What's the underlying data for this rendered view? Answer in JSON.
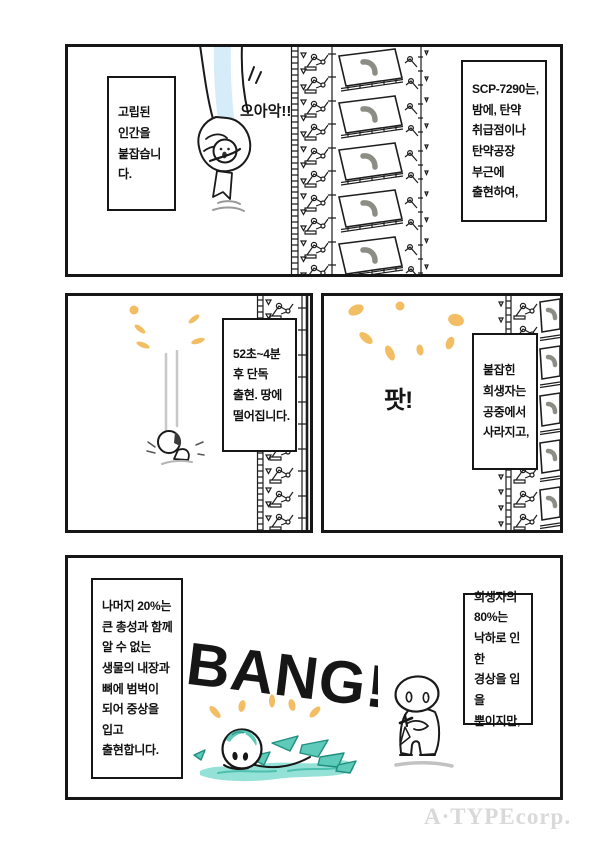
{
  "watermark": "A·TYPEcorp.",
  "colors": {
    "ink": "#1a1a1a",
    "accent_orange": "#f2bd63",
    "pale_blue": "#d6ecf8",
    "teal": "#5ecab9",
    "teal_light": "#93e1d7",
    "teal_dark": "#1f8f80",
    "watermark_gray": "#d9d9d9"
  },
  "panels": {
    "p1": {
      "caption_left": "고립된\n인간을\n붙잡습니다.",
      "scream": "으아악!!",
      "caption_right": "SCP-7290는,\n밤에, 탄약\n취급점이나\n탄약공장\n부근에\n출현하여,"
    },
    "p2_left": {
      "caption": "52초~4분\n후 단독\n출현. 땅에\n떨어집니다."
    },
    "p2_right": {
      "sfx": "팟!",
      "caption": "붙잡힌\n희생자는\n공중에서\n사라지고,"
    },
    "p3": {
      "caption_left": "나머지 20%는\n큰 총성과 함께\n알 수 없는\n생물의 내장과\n뼈에 범벅이\n되어 중상을\n입고\n출현합니다.",
      "sfx": "BANG!",
      "caption_right": "희생자의\n80%는\n낙하로 인한\n경상을 입을\n뿐이지만,"
    }
  }
}
